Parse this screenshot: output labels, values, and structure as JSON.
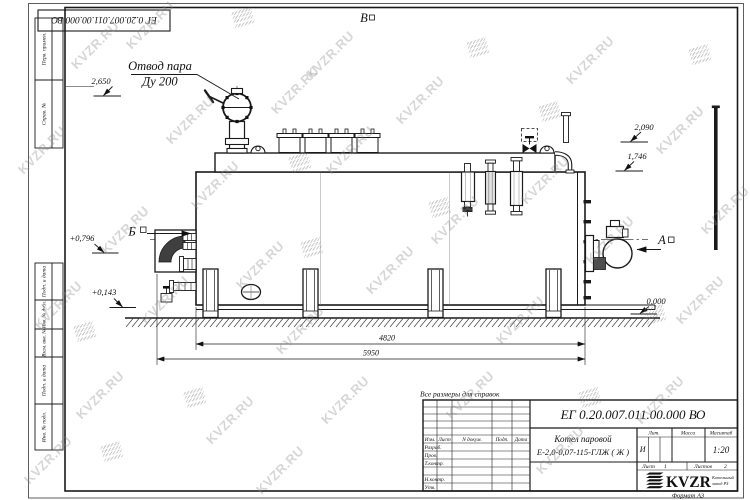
{
  "colors": {
    "ink": "#1a1a1a",
    "watermark_gray": "#8a8a8a"
  },
  "watermark": {
    "text": "KVZR.RU"
  },
  "stamp_top": {
    "doc_number": "ЕГ 0.20.007.011.00.000  ВО"
  },
  "margin": {
    "labels": [
      "Перв. примен.",
      "Справ. №",
      "Подп. и дата",
      "Инв. № дубл.",
      "Взам. инв. №",
      "Подп. и дата",
      "Инв. № подл."
    ]
  },
  "drawing": {
    "note": "Все размеры для справок",
    "callout": {
      "line1": "Отвод пара",
      "line2": "Ду 200"
    },
    "views": {
      "a": "А",
      "b": "Б",
      "v": "В"
    },
    "elevations": {
      "top": "2,650",
      "stack": "2,090",
      "drum": "1,746",
      "left_upper": "+0,796",
      "left_lower": "+0,143",
      "ground": "0,000"
    },
    "dims": {
      "body": "4820",
      "overall": "5950"
    }
  },
  "title_block": {
    "doc_number": "ЕГ 0.20.007.011.00.000  ВО",
    "product_line1": "Котел паровой",
    "product_line2": "Е-2,0-0,07-115-ГЛЖ ( Ж )",
    "col_izm": "Изм.",
    "col_list": "Лист",
    "col_ndoc": "N докум.",
    "col_podp": "Подп.",
    "col_data": "Дата",
    "row_razrab": "Разраб.",
    "row_prov": "Пров.",
    "row_tkontr": "Т.контр.",
    "row_nkontr": "Н.контр.",
    "row_utv": "Утв.",
    "lit_label": "Лит.",
    "massa_label": "Масса",
    "masshtab_label": "Масштаб",
    "lit_value": "И",
    "scale_value": "1:20",
    "sheet_label": "Лист",
    "sheet_value": "1",
    "sheets_label": "Листов",
    "sheets_value": "2",
    "logo_text": "KVZR",
    "logo_sub1": "Котельный",
    "logo_sub2": "завод РЗ",
    "format_label": "Формат А3"
  }
}
